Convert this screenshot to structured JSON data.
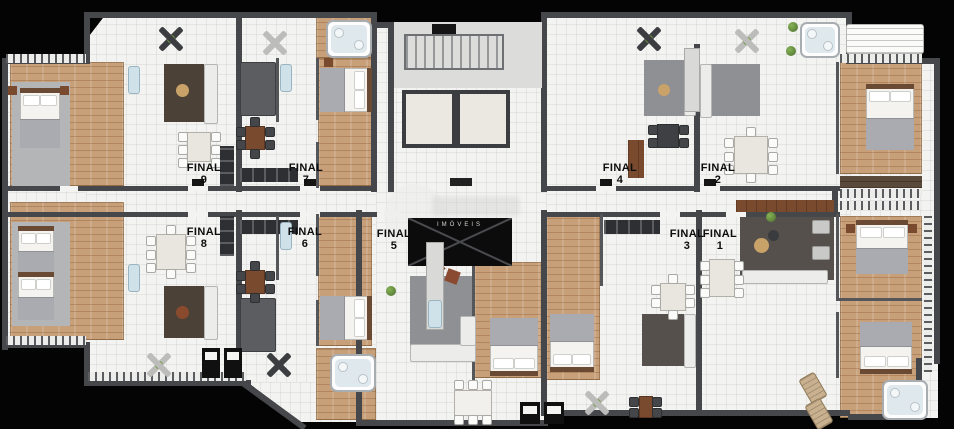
{
  "plan": {
    "type": "residential-floor-plan",
    "watermark_text": "IMÓVEIS",
    "units": [
      {
        "label": "FINAL",
        "number": "1"
      },
      {
        "label": "FINAL",
        "number": "2"
      },
      {
        "label": "FINAL",
        "number": "3"
      },
      {
        "label": "FINAL",
        "number": "4"
      },
      {
        "label": "FINAL",
        "number": "5"
      },
      {
        "label": "FINAL",
        "number": "6"
      },
      {
        "label": "FINAL",
        "number": "7"
      },
      {
        "label": "FINAL",
        "number": "8"
      },
      {
        "label": "FINAL",
        "number": "9"
      }
    ]
  },
  "colors": {
    "background": "#040404",
    "floor": "#f3f3f1",
    "wall": "#46474b",
    "wood": "#c79f78",
    "accent_green": "#6f9c43",
    "void_box": "#0c0c0c"
  }
}
